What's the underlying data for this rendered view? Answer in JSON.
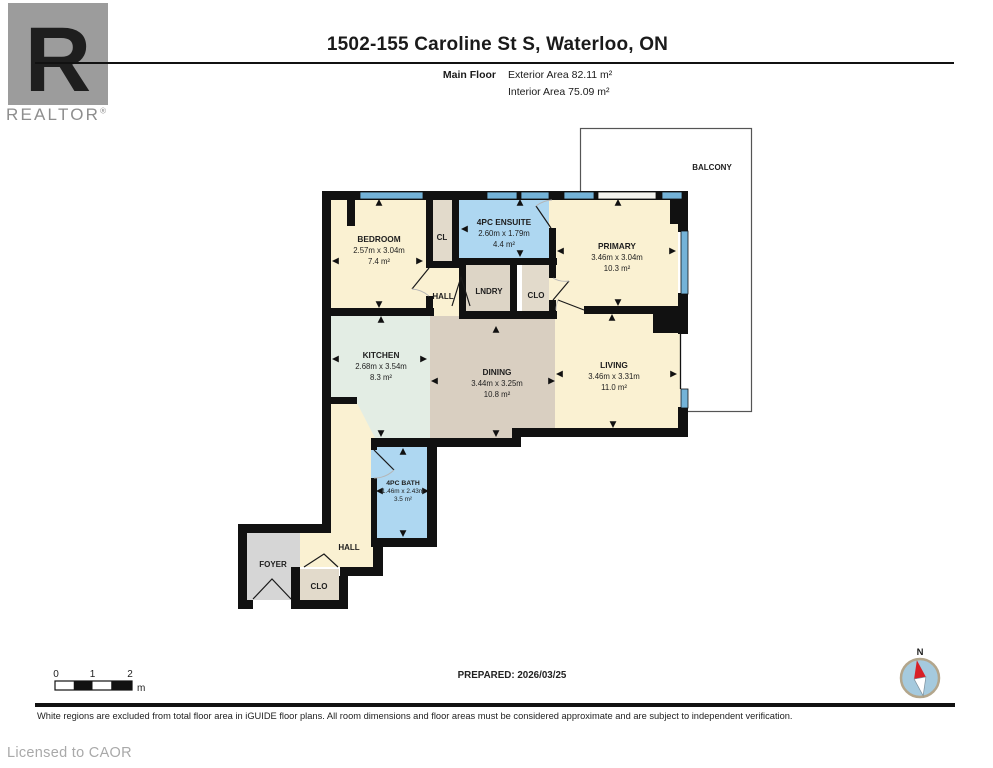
{
  "logo": {
    "brand": "REALTOR",
    "registered": "®",
    "letter": "R"
  },
  "header": {
    "title": "1502-155 Caroline St S, Waterloo, ON",
    "floor_label": "Main Floor",
    "exterior_area": "Exterior Area 82.11 m²",
    "interior_area": "Interior Area 75.09 m²"
  },
  "plan": {
    "rooms": {
      "balcony": {
        "name": "BALCONY"
      },
      "bedroom": {
        "name": "BEDROOM",
        "dims": "2.57m x 3.04m",
        "area": "7.4 m²"
      },
      "cl": {
        "name": "CL"
      },
      "ensuite": {
        "name": "4PC ENSUITE",
        "dims": "2.60m x 1.79m",
        "area": "4.4 m²"
      },
      "primary": {
        "name": "PRIMARY",
        "dims": "3.46m x 3.04m",
        "area": "10.3 m²"
      },
      "hall_upper": {
        "name": "HALL"
      },
      "laundry": {
        "name": "LNDRY"
      },
      "closet_upper": {
        "name": "CLO"
      },
      "kitchen": {
        "name": "KITCHEN",
        "dims": "2.68m x 3.54m",
        "area": "8.3 m²"
      },
      "dining": {
        "name": "DINING",
        "dims": "3.44m x 3.25m",
        "area": "10.8 m²"
      },
      "living": {
        "name": "LIVING",
        "dims": "3.46m x 3.31m",
        "area": "11.0 m²"
      },
      "bath": {
        "name": "4PC BATH",
        "dims": "1.46m x 2.43m",
        "area": "3.5 m²"
      },
      "hall_lower": {
        "name": "HALL"
      },
      "foyer": {
        "name": "FOYER"
      },
      "closet_lower": {
        "name": "CLO"
      }
    },
    "colors": {
      "wall": "#111111",
      "cream": "#faf1d2",
      "tan": "#d9cfc1",
      "mint": "#e3ede4",
      "blue": "#aed7f1",
      "beige": "#e2dacb",
      "gray": "#d6d6d6",
      "window": "#74b3d8"
    }
  },
  "scale_bar": {
    "tick0": "0",
    "tick1": "1",
    "tick2": "2",
    "unit": "m"
  },
  "prepared_label": "PREPARED: 2026/03/25",
  "compass": {
    "north_label": "N"
  },
  "footer": {
    "disclaimer": "White regions are excluded from total floor area in iGUIDE floor plans. All room dimensions and floor areas must be considered approximate and are subject to independent verification.",
    "license": "Licensed to CAOR"
  }
}
